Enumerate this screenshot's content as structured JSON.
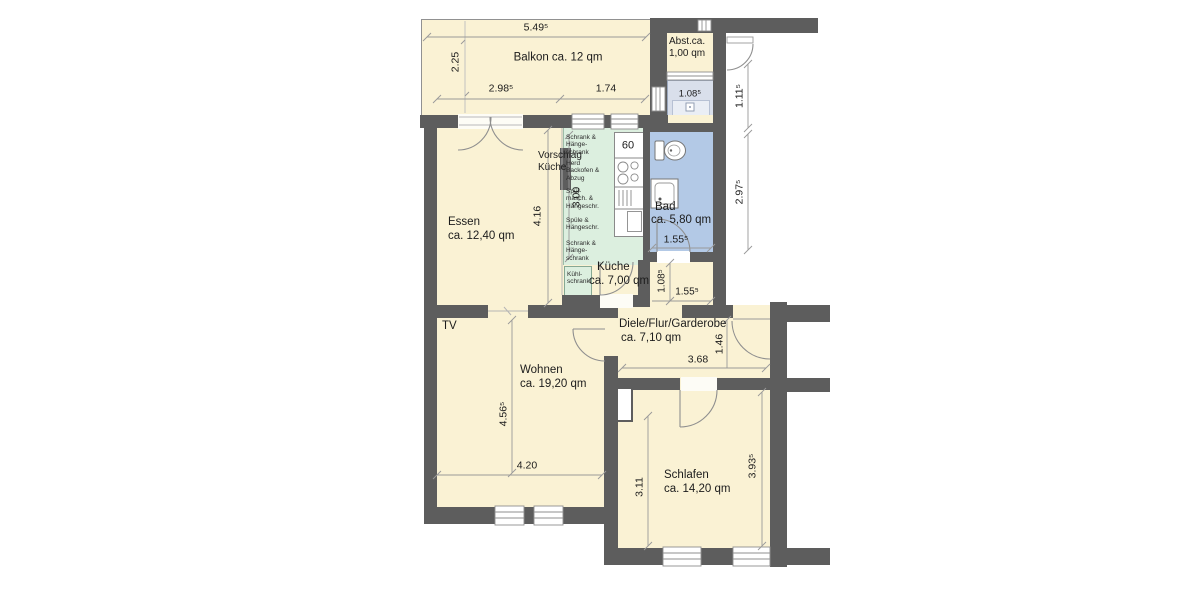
{
  "plan_title": "Wohnung Grundriss (floor plan)",
  "colors": {
    "wall": "#5d5d5d",
    "room_floor": "#faf2d4",
    "kitchen_cabinets": "#dcefdf",
    "bathroom": "#b3c9e6",
    "light_shaft": "#d9dfeb",
    "linework": "#8f8f8f"
  },
  "rooms": {
    "balkon": {
      "label": "Balkon ca. 12 qm"
    },
    "abstell": {
      "label": "Abst.ca.\n1,00 qm"
    },
    "essen": {
      "name": "Essen",
      "area": "ca. 12,40 qm"
    },
    "vorschlag": {
      "label": "Vorschlag\nKüche"
    },
    "kueche": {
      "name": "Küche",
      "area": "ca. 7,00 qm"
    },
    "bad": {
      "name": "Bad",
      "area": "ca. 5,80 qm"
    },
    "diele": {
      "name": "Diele/Flur/Garderobe",
      "area": "ca. 7,10 qm"
    },
    "wohnen": {
      "name": "Wohnen",
      "area": "ca. 19,20 qm"
    },
    "schlafen": {
      "name": "Schlafen",
      "area": "ca. 14,20 qm"
    },
    "tv": "TV"
  },
  "kitchen": {
    "unit_width": "60",
    "cabinets": [
      "Schrank &\nHänge-\nschrank",
      "Herd\nBackofen &\nAbzug",
      "Spül-\nmasch. &\nHängeschr.",
      "Spüle &\nHängeschr.",
      "Schrank &\nHänge-\nschrank",
      "Kühl-\nschrank"
    ]
  },
  "dims": {
    "balkon_top": "5.49⁵",
    "balkon_left": "2.25",
    "balkon_bottom_1": "2.98⁵",
    "balkon_bottom_2": "1.74",
    "shaft_width": "1.08⁵",
    "right_upper": "1.11⁵",
    "right_lower": "2.97⁵",
    "kitchen_length": "3.00",
    "essen_height": "4.16",
    "bad_width": "1.55⁵",
    "corridor_width": "1.08⁵",
    "corridor_length": "1.55⁵",
    "diele_width": "3.68",
    "diele_height": "1.46",
    "wohnen_height": "4.56⁵",
    "wohnen_width": "4.20",
    "schlafen_left_height": "3.11",
    "schlafen_right_height": "3.93⁵"
  }
}
